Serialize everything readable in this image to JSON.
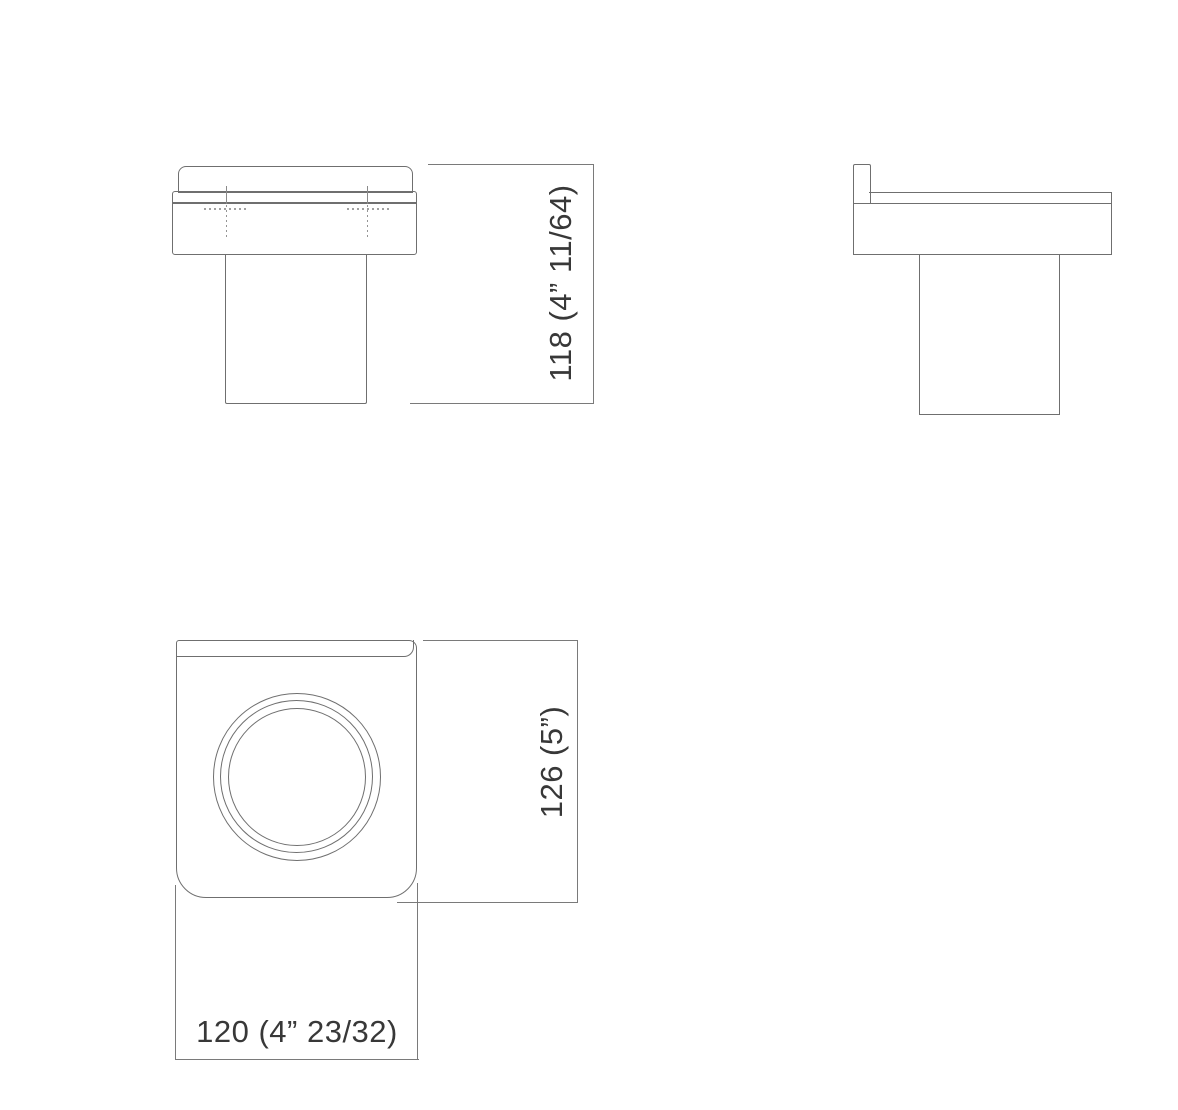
{
  "drawing": {
    "background_color": "#ffffff",
    "line_color": "#6f6f6f",
    "hidden_line_color": "#949494",
    "text_color": "#383838",
    "front_view": {
      "height_dimension": "118 (4” 11/64)"
    },
    "plan_view": {
      "height_dimension": "126 (5”)",
      "width_dimension": "120 (4” 23/32)"
    }
  }
}
